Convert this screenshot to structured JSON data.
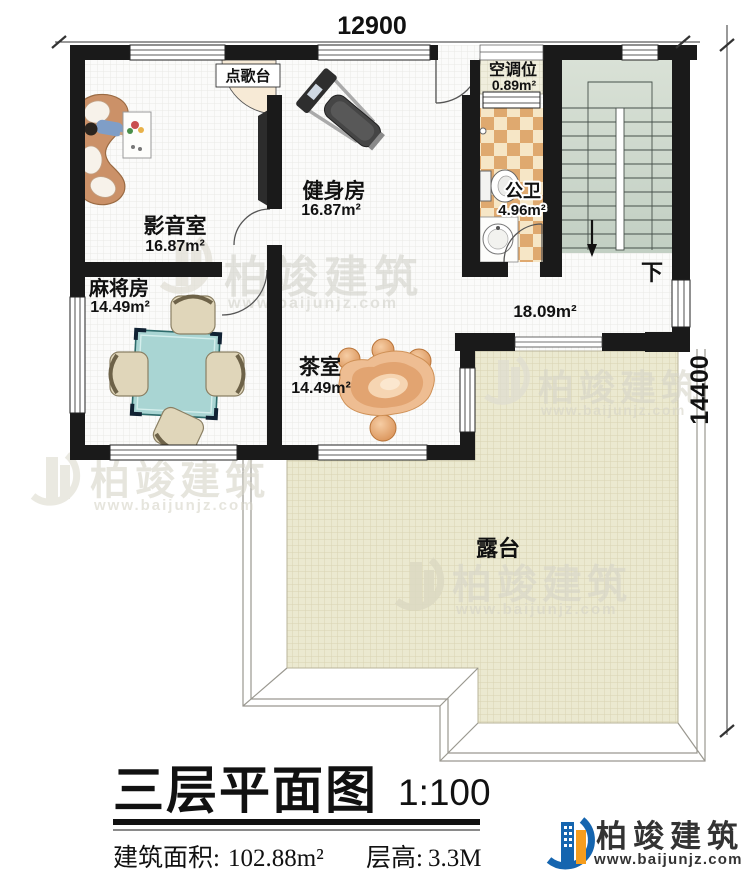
{
  "dimensions": {
    "top": "12900",
    "right": "14400"
  },
  "rooms": {
    "media": {
      "name": "影音室",
      "area": "16.87m²"
    },
    "gym": {
      "name": "健身房",
      "area": "16.87m²"
    },
    "ac": {
      "name": "空调位",
      "area": "0.89m²"
    },
    "bath": {
      "name": "公卫",
      "area": "4.96m²"
    },
    "mahjong": {
      "name": "麻将房",
      "area": "14.49m²"
    },
    "tea": {
      "name": "茶室",
      "area": "14.49m²"
    },
    "hall": {
      "area": "18.09m²"
    },
    "terrace": {
      "name": "露台"
    },
    "karaoke": {
      "name": "点歌台"
    },
    "stairs": {
      "down_label": "下"
    }
  },
  "title": {
    "main": "三层平面图",
    "scale": "1:100",
    "area_label": "建筑面积:",
    "area_value": "102.88m²",
    "height_label": "层高:",
    "height_value": "3.3M"
  },
  "brand": {
    "name": "柏竣建筑",
    "website": "www.baijunjz.com"
  },
  "watermark": {
    "name": "柏竣建筑",
    "website": "www.baijunjz.com"
  },
  "colors": {
    "wall": "#1a1a1a",
    "terrace": "#ebe9d0",
    "stairs": "#ccd7cb",
    "tile_dark": "#dfa96f",
    "tile_light": "#f6e6c6",
    "mahjong_table": "#a9d5d3",
    "logo_blue": "#1565af",
    "logo_orange": "#f59d1e"
  }
}
